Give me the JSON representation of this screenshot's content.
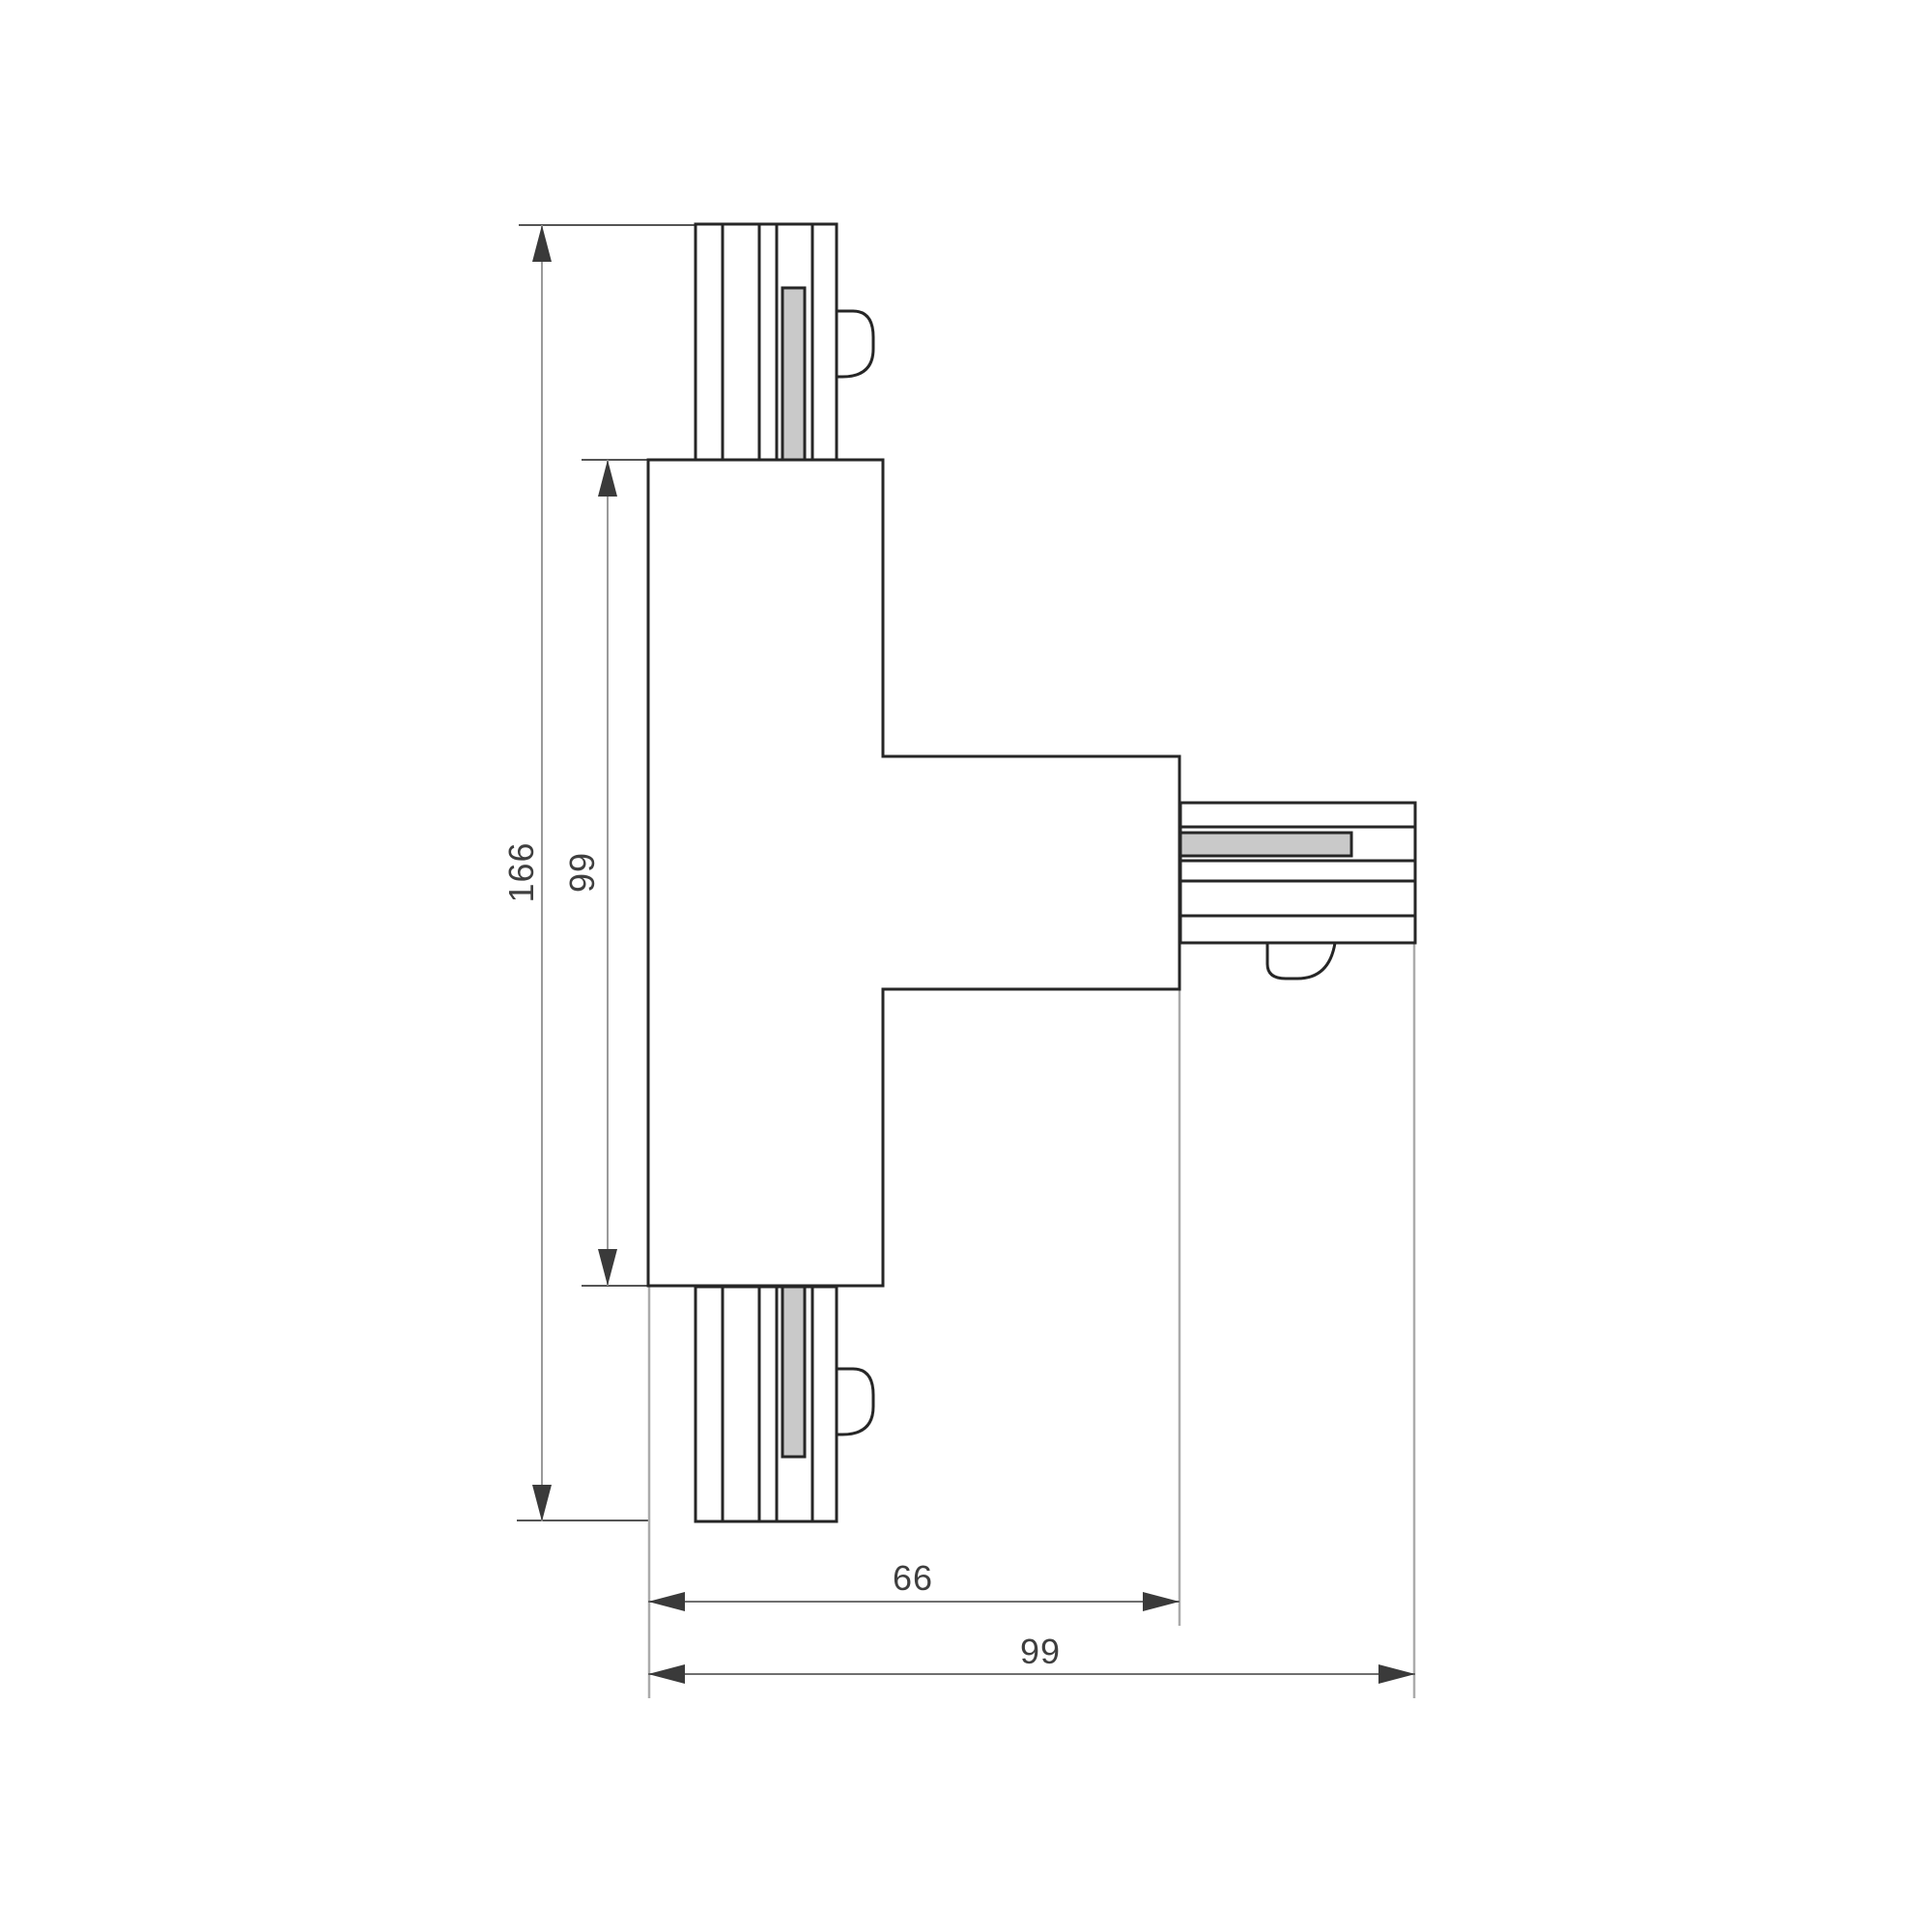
{
  "drawing": {
    "kind": "dimensioned-technical-drawing",
    "figure": "t-shaped-track-connector",
    "dimensions": {
      "overall_height": {
        "label": "166",
        "orientation": "vertical"
      },
      "inner_height": {
        "label": "99",
        "orientation": "vertical"
      },
      "arm_width": {
        "label": "66",
        "orientation": "horizontal"
      },
      "overall_width": {
        "label": "99",
        "orientation": "horizontal"
      }
    },
    "colors": {
      "background": "#ffffff",
      "outline": "#262626",
      "conductor_fill": "#c9c9c9",
      "dimension_line_vertical": "#9a9a9a",
      "dimension_line_horizontal": "#6f6f6f",
      "extension_line": "#ababab",
      "arrow": "#3a3a3a",
      "label_text": "#3f3f3f"
    }
  }
}
